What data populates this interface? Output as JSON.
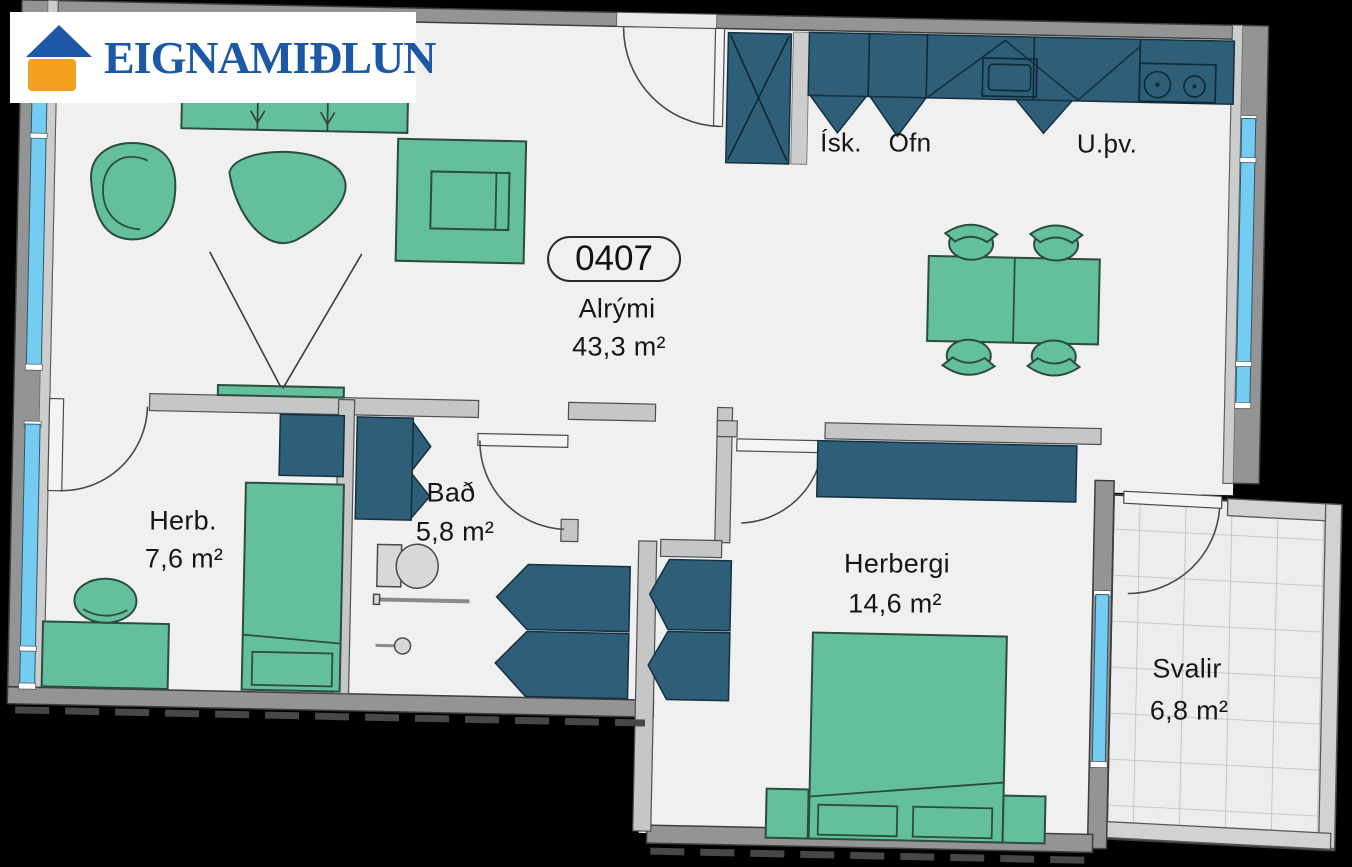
{
  "logo": {
    "name": "EIGNAMIÐLUN"
  },
  "unit": {
    "number": "0407"
  },
  "rooms": [
    {
      "id": "alrymi",
      "label": "Alrými",
      "area": "43,3 m²"
    },
    {
      "id": "herb",
      "label": "Herb.",
      "area": "7,6 m²"
    },
    {
      "id": "bad",
      "label": "Bað",
      "area": "5,8 m²"
    },
    {
      "id": "herbergi",
      "label": "Herbergi",
      "area": "14,6 m²"
    },
    {
      "id": "svalir",
      "label": "Svalir",
      "area": "6,8 m²"
    }
  ],
  "appliances": {
    "fridge": "Ísk.",
    "oven": "Ofn",
    "dishwasher": "U.þv."
  },
  "colors": {
    "bg": "#000000",
    "floor": "#f0f0f1",
    "wall-outer": "#949494",
    "wall-inner": "#c6c6c6",
    "window-blue": "#74ccf1",
    "green": "#64bf9d",
    "green-line": "#2d4c40",
    "teal": "#2e5e78",
    "teal-line": "#14303f",
    "logo-blue": "#1d58a7",
    "logo-orange": "#f2a11e",
    "text": "#161616"
  }
}
